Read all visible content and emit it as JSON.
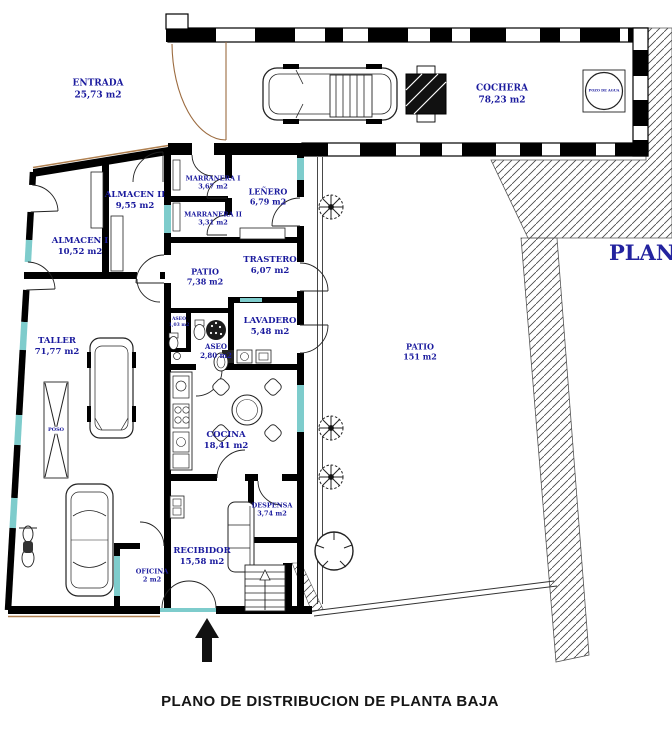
{
  "title": "PLANO DE DISTRIBUCION DE PLANTA BAJA",
  "corner_label": "PLANTA",
  "rooms": {
    "entrada": {
      "name": "ENTRADA",
      "area": "25,73 m2"
    },
    "cochera": {
      "name": "COCHERA",
      "area": "78,23 m2"
    },
    "pozo": {
      "name": "POZO DE AGUA"
    },
    "almacen2": {
      "name": "ALMACEN II",
      "area": "9,55 m2"
    },
    "almacen1": {
      "name": "ALMACEN I",
      "area": "10,52 m2"
    },
    "marranera1": {
      "name": "MARRANERA I",
      "area": "3,67 m2"
    },
    "marranera2": {
      "name": "MARRANERA II",
      "area": "3,31 m2"
    },
    "lenero": {
      "name": "LEÑERO",
      "area": "6,79 m2"
    },
    "patio_small": {
      "name": "PATIO",
      "area": "7,38 m2"
    },
    "trastero": {
      "name": "TRASTERO",
      "area": "6,07 m2"
    },
    "lavadero": {
      "name": "LAVADERO",
      "area": "5,48 m2"
    },
    "aseo_small": {
      "name": "ASEO",
      "area": "1,03 m2"
    },
    "aseo": {
      "name": "ASEO",
      "area": "2,80 m2"
    },
    "taller": {
      "name": "TALLER",
      "area": "71,77 m2"
    },
    "poso": {
      "name": "POSO"
    },
    "patio_large": {
      "name": "PATIO",
      "area": "151 m2"
    },
    "cocina": {
      "name": "COCINA",
      "area": "18,41 m2"
    },
    "despensa": {
      "name": "DESPENSA",
      "area": "3,74 m2"
    },
    "recibidor": {
      "name": "RECIBIDOR",
      "area": "15,58 m2"
    },
    "oficina": {
      "name": "OFICINA",
      "area": "2 m2"
    }
  },
  "colors": {
    "label_blue": "#1b1b9e",
    "wall_black": "#000000",
    "window_cyan": "#7ecccc",
    "door_tan": "#b08050",
    "title_black": "#151515"
  }
}
